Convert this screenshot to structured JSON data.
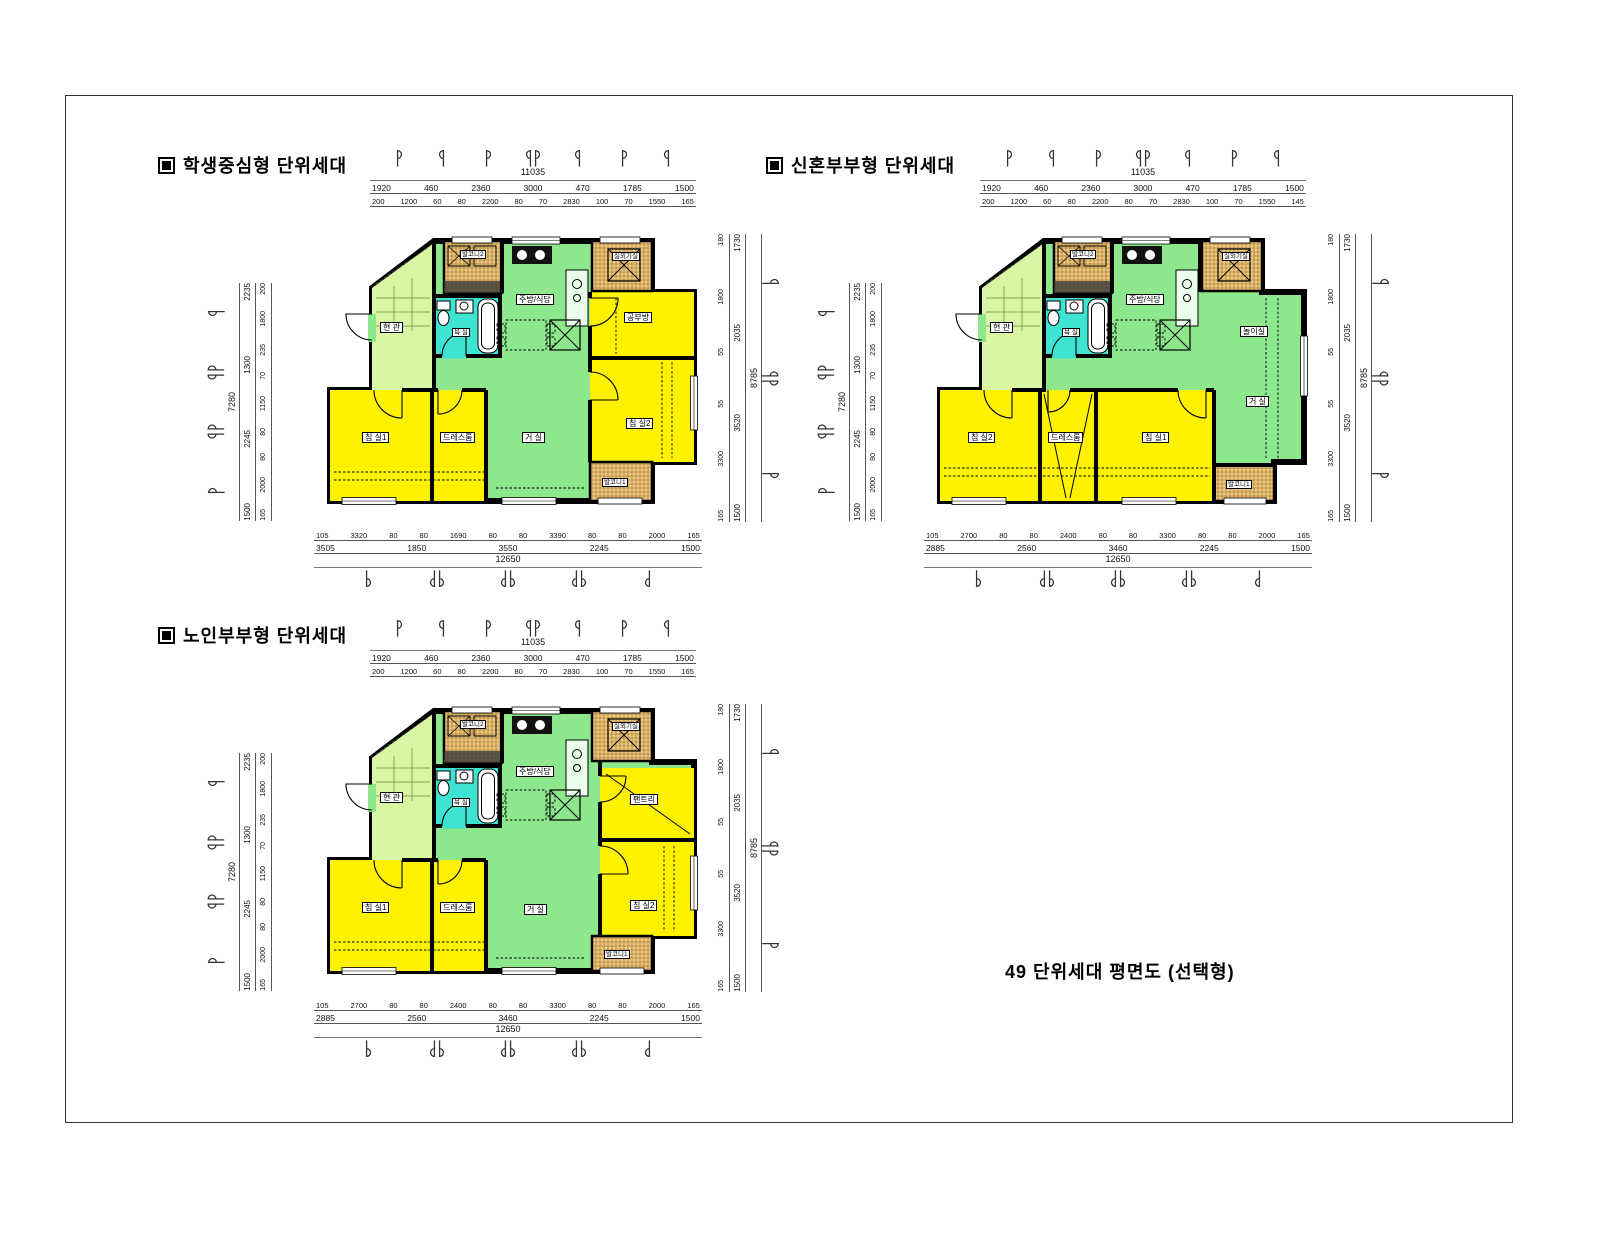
{
  "palette": {
    "living_green": "#8DE88D",
    "entrance_green": "#D8F6A4",
    "room_yellow": "#FFF200",
    "balcony_orange": "#F2C87E",
    "bath_cyan": "#3FE3D1",
    "wall_black": "#000000"
  },
  "caption": "49 단위세대 평면도 (선택형)",
  "plans": [
    {
      "title": "학생중심형 단위세대",
      "rooms": {
        "entrance": "현 관",
        "kitchen": "주방/식당",
        "bath": "욕 실",
        "living": "거 실",
        "bed1": "침 실1",
        "bed2": "침 실2",
        "dress": "드레스룸",
        "study": "공부방",
        "balcony1": "발코니1",
        "balcony2": "발코니2",
        "ac_unit": "실외기실"
      },
      "dims": {
        "top": {
          "total": "11035",
          "row2": [
            "1920",
            "460",
            "2360",
            "3000",
            "470",
            "1785",
            "1500"
          ],
          "row3": [
            "200",
            "1200",
            "60",
            "80",
            "2200",
            "80",
            "70",
            "2830",
            "100",
            "70",
            "1550",
            "165"
          ]
        },
        "left": {
          "total": "7280",
          "outer": [
            "2235",
            "1300",
            "2245",
            "1500"
          ],
          "inner": [
            "200",
            "1800",
            "235",
            "70",
            "1150",
            "80",
            "80",
            "2000",
            "165"
          ]
        },
        "right": {
          "total": "8785",
          "outer": [
            "1730",
            "2035",
            "3520",
            "1500"
          ],
          "inner": [
            "180",
            "1800",
            "55",
            "55",
            "3300",
            "165"
          ]
        },
        "bottom": {
          "row1": [
            "105",
            "3320",
            "80",
            "80",
            "1690",
            "80",
            "80",
            "3390",
            "80",
            "80",
            "2000",
            "165"
          ],
          "row2": [
            "3505",
            "1850",
            "3550",
            "2245",
            "1500"
          ],
          "total": "12650"
        }
      }
    },
    {
      "title": "신혼부부형 단위세대",
      "rooms": {
        "entrance": "현 관",
        "kitchen": "주방/식당",
        "bath": "욕 실",
        "living": "거 실",
        "play": "놀이실",
        "bed1": "침 실1",
        "bed2": "침 실2",
        "dress": "드레스룸",
        "balcony1": "발코니1",
        "balcony2": "발코니2",
        "ac_unit": "실외기실"
      },
      "dims": {
        "top": {
          "total": "11035",
          "row2": [
            "1920",
            "460",
            "2360",
            "3000",
            "470",
            "1785",
            "1500"
          ],
          "row3": [
            "200",
            "1200",
            "60",
            "80",
            "2200",
            "80",
            "70",
            "2830",
            "100",
            "70",
            "1550",
            "145"
          ]
        },
        "left": {
          "total": "7280",
          "outer": [
            "2235",
            "1300",
            "2245",
            "1500"
          ],
          "inner": [
            "200",
            "1800",
            "235",
            "70",
            "1150",
            "80",
            "80",
            "2000",
            "165"
          ]
        },
        "right": {
          "total": "8785",
          "outer": [
            "1730",
            "2035",
            "3520",
            "1500"
          ],
          "inner": [
            "180",
            "1800",
            "55",
            "55",
            "3300",
            "165"
          ]
        },
        "bottom": {
          "row1": [
            "105",
            "2700",
            "80",
            "80",
            "2400",
            "80",
            "80",
            "3300",
            "80",
            "80",
            "2000",
            "165"
          ],
          "row2": [
            "2885",
            "2560",
            "3460",
            "2245",
            "1500"
          ],
          "total": "12650"
        }
      }
    },
    {
      "title": "노인부부형 단위세대",
      "rooms": {
        "entrance": "현 관",
        "kitchen": "주방/식당",
        "bath": "욕 실",
        "living": "거 실",
        "bed1": "침 실1",
        "bed2": "침 실2",
        "dress": "드레스룸",
        "pantry": "팬트리",
        "balcony1": "발코니1",
        "balcony2": "발코니2",
        "ac_unit": "실외기실"
      },
      "dims": {
        "top": {
          "total": "11035",
          "row2": [
            "1920",
            "460",
            "2360",
            "3000",
            "470",
            "1785",
            "1500"
          ],
          "row3": [
            "200",
            "1200",
            "60",
            "80",
            "2200",
            "80",
            "70",
            "2830",
            "100",
            "70",
            "1550",
            "165"
          ]
        },
        "left": {
          "total": "7280",
          "outer": [
            "2235",
            "1300",
            "2245",
            "1500"
          ],
          "inner": [
            "200",
            "1800",
            "235",
            "70",
            "1150",
            "80",
            "80",
            "2000",
            "165"
          ]
        },
        "right": {
          "total": "8785",
          "outer": [
            "1730",
            "2035",
            "3520",
            "1500"
          ],
          "inner": [
            "180",
            "1800",
            "55",
            "55",
            "3300",
            "165"
          ]
        },
        "bottom": {
          "row1": [
            "105",
            "2700",
            "80",
            "80",
            "2400",
            "80",
            "80",
            "3300",
            "80",
            "80",
            "2000",
            "165"
          ],
          "row2": [
            "2885",
            "2560",
            "3460",
            "2245",
            "1500"
          ],
          "total": "12650"
        }
      }
    }
  ]
}
